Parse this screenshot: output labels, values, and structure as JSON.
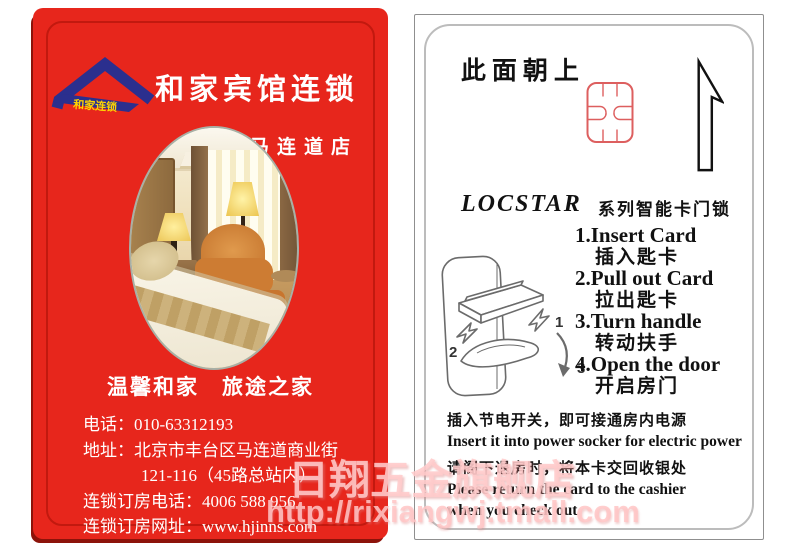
{
  "front_card": {
    "logo_text": "和家连锁",
    "title": "和家宾馆连锁",
    "branch": "马连道店",
    "slogan": "温馨和家　旅途之家",
    "contact": {
      "phone_label": "电话：",
      "phone": "010-63312193",
      "address_label": "地址：",
      "address_line1": "北京市丰台区马连道商业街",
      "address_line2": "121-116（45路总站内）",
      "booking_phone_label": "连锁订房电话：",
      "booking_phone": "4006 588 956",
      "booking_web_label": "连锁订房网址：",
      "booking_web": "www.hjinns.com"
    }
  },
  "back_card": {
    "orientation_note": "此面朝上",
    "brand": "LOCSTAR",
    "brand_desc": "系列智能卡门锁",
    "steps": [
      {
        "en": "1.Insert Card",
        "zh": "插入匙卡"
      },
      {
        "en": "2.Pull out Card",
        "zh": "拉出匙卡"
      },
      {
        "en": "3.Turn handle",
        "zh": "转动扶手"
      },
      {
        "en": "4.Open the door",
        "zh": "开启房门"
      }
    ],
    "lock_labels": [
      "1",
      "2",
      "3"
    ],
    "power_note_zh": "插入节电开关，即可接通房内电源",
    "power_note_en": "Insert it into power socker for electric power",
    "return_note_zh": "请阁下退房时，将本卡交回收银处",
    "return_note_en_line1": "Please return the card to the cashier",
    "return_note_en_line2": "when you check out"
  },
  "watermark": {
    "store": "日翔五金旗舰店",
    "url": "http://rixiangwj.tmall.com"
  },
  "colors": {
    "card_red": "#e7261c",
    "inner_border_red": "#c2190f",
    "logo_blue": "#2b2f8e",
    "logo_yellow": "#ffd400",
    "chip_outline_red": "#dd5f5f",
    "watermark_pink": "#ffc9c9"
  }
}
